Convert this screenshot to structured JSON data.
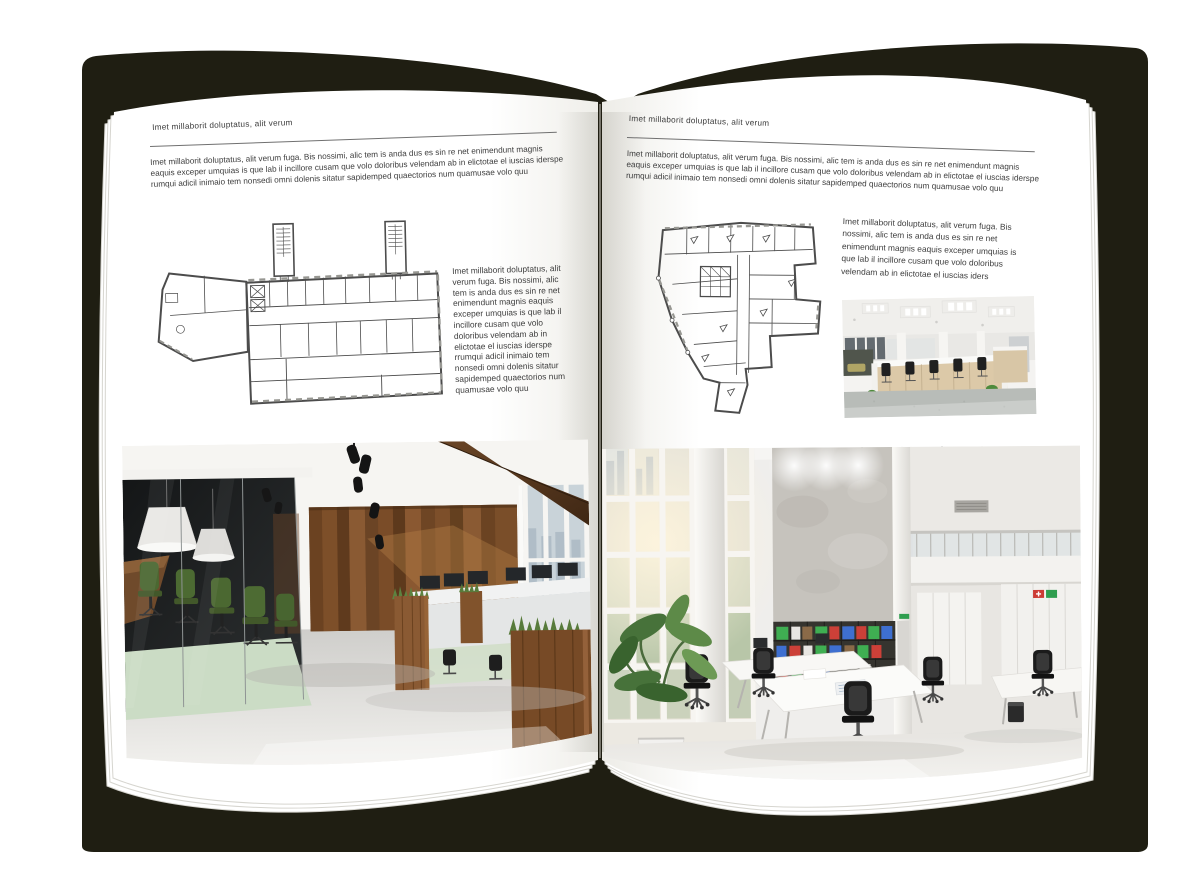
{
  "canvas": {
    "background": "#ffffff"
  },
  "book": {
    "cover_color": "#1f1e12",
    "page_color": "#ffffff",
    "kind": "open-magazine-spread-mockup"
  },
  "left_page": {
    "header": "Imet millaborit doluptatus, alit verum",
    "intro": "Imet millaborit doluptatus, alit verum fuga. Bis nossimi, alic tem is anda dus es sin re net enimendunt magnis eaquis exceper umquias is que lab il incillore cusam que volo doloribus velendam ab in elictotae el iuscias iderspe rumqui adicil inimaio tem nonsedi omni dolenis sitatur sapidemped quaectorios num quamusae volo quu",
    "caption": "Imet millaborit doluptatus, alit verum fuga. Bis nossimi, alic tem is anda dus es sin re net enimendunt magnis eaquis exceper umquias is que lab il incillore cusam que volo doloribus velendam ab in elictotae el iuscias iderspe rrumqui adicil inimaio tem nonsedi omni dolenis sitatur sapidemped quaectorios num quamusae volo quu",
    "figures": {
      "floor_plan": "floor-plan-wide-building-with-twin-stair-towers",
      "photo": "office-interior-dark-glass-meeting-room-and-wood-wall"
    }
  },
  "right_page": {
    "header": "Imet millaborit doluptatus, alit verum",
    "intro": "Imet millaborit doluptatus, alit verum fuga. Bis nossimi, alic tem is anda dus es sin re net enimendunt magnis eaquis exceper umquias is que lab il incillore cusam que volo doloribus velendam ab in elictotae el iuscias iderspe rumqui adicil inimaio tem nonsedi omni dolenis sitatur sapidemped quaectorios num quamusae volo quu",
    "caption": "Imet millaborit doluptatus, alit verum fuga. Bis nossimi, alic tem is anda dus es sin re net enimendunt magnis eaquis exceper umquias is que lab il incillore cusam que volo doloribus velendam ab in elictotae el iuscias iders",
    "figures": {
      "floor_plan": "floor-plan-irregular-building",
      "photo_small": "open-plan-office-desk-rows",
      "photo_large": "bright-double-height-office-atrium"
    }
  }
}
